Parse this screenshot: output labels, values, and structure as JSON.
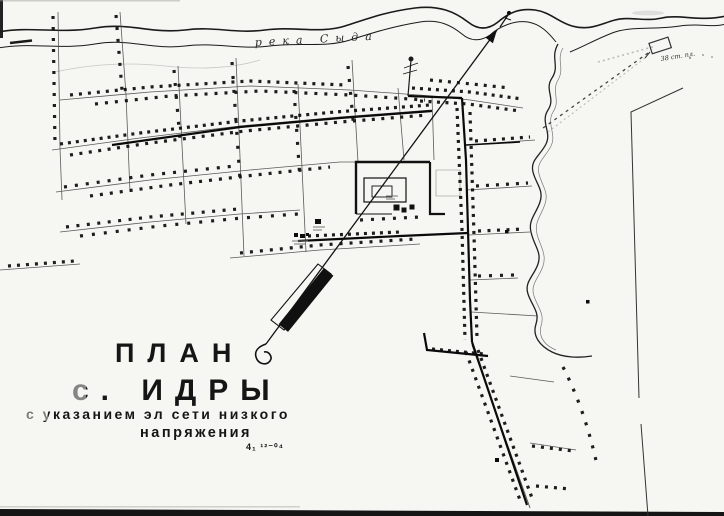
{
  "page": {
    "kind": "scanned village plan",
    "background": "#f6f6f2",
    "ink": "#141414"
  },
  "title_block": {
    "line1": "ПЛАН",
    "line2": "с. ИДРЫ",
    "line3": "с указанием эл сети низкого",
    "line4": "напряжения",
    "note": "4₁ ¹²⁻⁰⁴"
  },
  "map_labels": {
    "river_name": "река Сыда",
    "field_annotation": "38 ст. пл."
  },
  "symbols": {
    "north_arrow": "long line, solid head, curled tail",
    "house": "▪",
    "survey_flag": "▭"
  }
}
